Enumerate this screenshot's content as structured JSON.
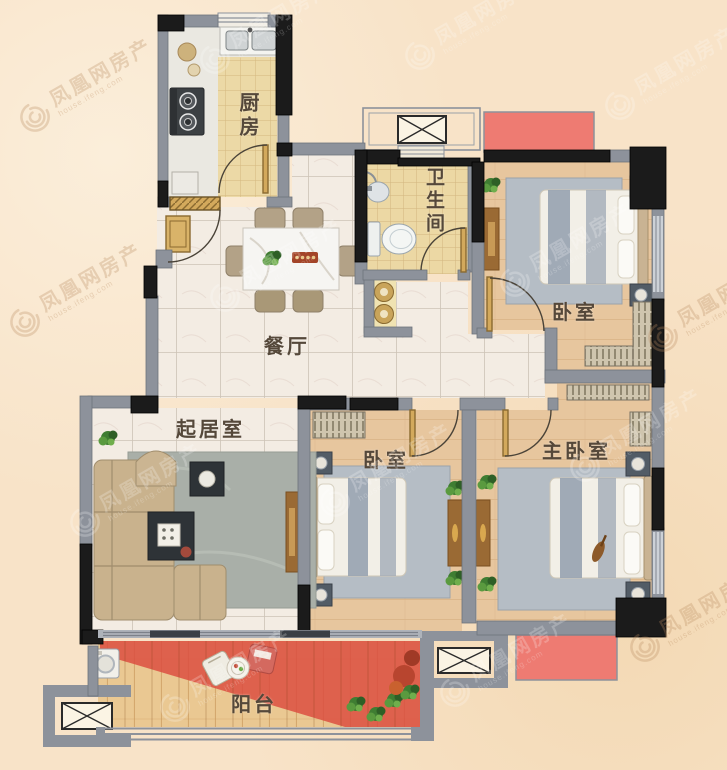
{
  "plan": {
    "labels": {
      "kitchen": "厨房",
      "bathroom": "卫生间",
      "bedroom_top": "卧室",
      "dining": "餐厅",
      "living": "起居室",
      "bedroom_middle": "卧室",
      "master_bedroom": "主卧室",
      "balcony": "阳台"
    },
    "colors": {
      "background": "#f8e3c8",
      "wall_gray": "#8d929b",
      "wall_black": "#1b1b1b",
      "ac_platform_red": "#ee7b72",
      "balcony_highlight_red": "#dc4b3e",
      "floor_marble": "#f3ece3",
      "floor_wood": "#e7c69e",
      "floor_tile_tan": "#ecd8a4",
      "bedroom_rug": "#b5bdc5",
      "living_rug": "#a9afa8",
      "sofa_tan": "#c9b28d"
    }
  },
  "watermark": {
    "brand": "凤凰网房产",
    "domain": "house.ifeng.com"
  }
}
